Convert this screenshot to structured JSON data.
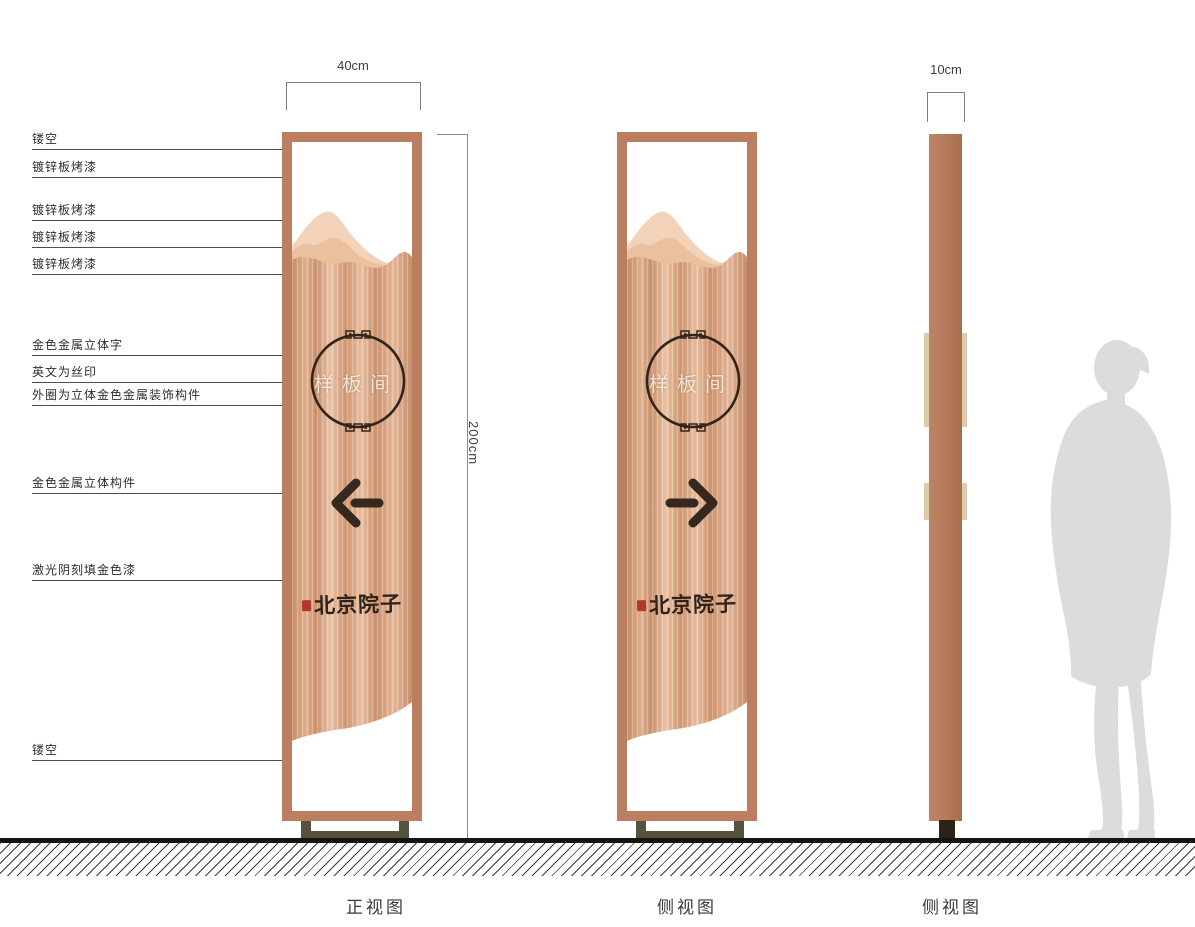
{
  "annotations": {
    "items": [
      "镂空",
      "镀锌板烤漆",
      "镀锌板烤漆",
      "镀锌板烤漆",
      "镀锌板烤漆",
      "金色金属立体字",
      "英文为丝印",
      "外圈为立体金色金属装饰构件",
      "金色金属立体构件",
      "激光阴刻填金色漆",
      "镂空"
    ]
  },
  "dimensions": {
    "width": "40cm",
    "height": "200cm",
    "depth": "10cm"
  },
  "sign": {
    "room_label": "样板间",
    "brand": "北京院子"
  },
  "captions": {
    "front": "正视图",
    "side": "侧视图",
    "profile": "侧视图"
  },
  "icons": {
    "front_arrow": "left-arrow-icon",
    "side_arrow": "right-arrow-icon",
    "circle_ornament": "fret-ring-icon",
    "seal": "red-seal-icon"
  },
  "colors": {
    "copper_frame": "#bb7f60",
    "copper_light": "#eec7ab",
    "copper_dark": "#cf9671",
    "mountain_back": "#f2d2b8",
    "mountain_mid": "#eac09f",
    "ink": "#33241a",
    "seal_red": "#b0392b",
    "stand_metal": "#56523e",
    "silhouette_gray": "#dcdcdc"
  }
}
